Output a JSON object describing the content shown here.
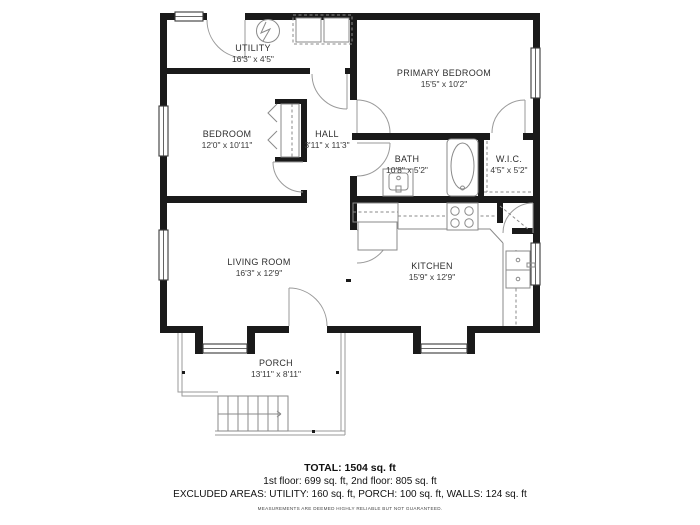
{
  "plan": {
    "rooms": [
      {
        "name": "UTILITY",
        "dims": "16'3\" x 4'5\""
      },
      {
        "name": "PRIMARY BEDROOM",
        "dims": "15'5\" x 10'2\""
      },
      {
        "name": "BEDROOM",
        "dims": "12'0\" x 10'11\""
      },
      {
        "name": "HALL",
        "dims": "3'11\" x 11'3\""
      },
      {
        "name": "BATH",
        "dims": "10'8\" x 5'2\""
      },
      {
        "name": "W.I.C.",
        "dims": "4'5\" x 5'2\""
      },
      {
        "name": "LIVING ROOM",
        "dims": "16'3\" x 12'9\""
      },
      {
        "name": "KITCHEN",
        "dims": "15'9\" x 12'9\""
      },
      {
        "name": "PORCH",
        "dims": "13'11\" x 8'11\""
      }
    ],
    "fixtures": [
      "water-heater",
      "washer-dryer",
      "closet-rod",
      "bathtub",
      "bath-sink",
      "toilet-area",
      "wic-shelving",
      "fridge",
      "stove",
      "kitchen-sink",
      "pantry",
      "stairs"
    ],
    "colors": {
      "wall": "#1a1a1a",
      "fixture_line": "#8a8a8a",
      "window_frame": "#3a3a3a",
      "text": "#2e2e2e"
    }
  },
  "summary": {
    "total": "TOTAL: 1504 sq. ft",
    "floors": "1st floor: 699 sq. ft, 2nd floor: 805 sq. ft",
    "excluded": "EXCLUDED AREAS: UTILITY: 160 sq. ft, PORCH: 100 sq. ft, WALLS: 124 sq. ft",
    "disclaimer": "MEASUREMENTS ARE DEEMED HIGHLY RELIABLE BUT NOT GUARANTEED."
  }
}
